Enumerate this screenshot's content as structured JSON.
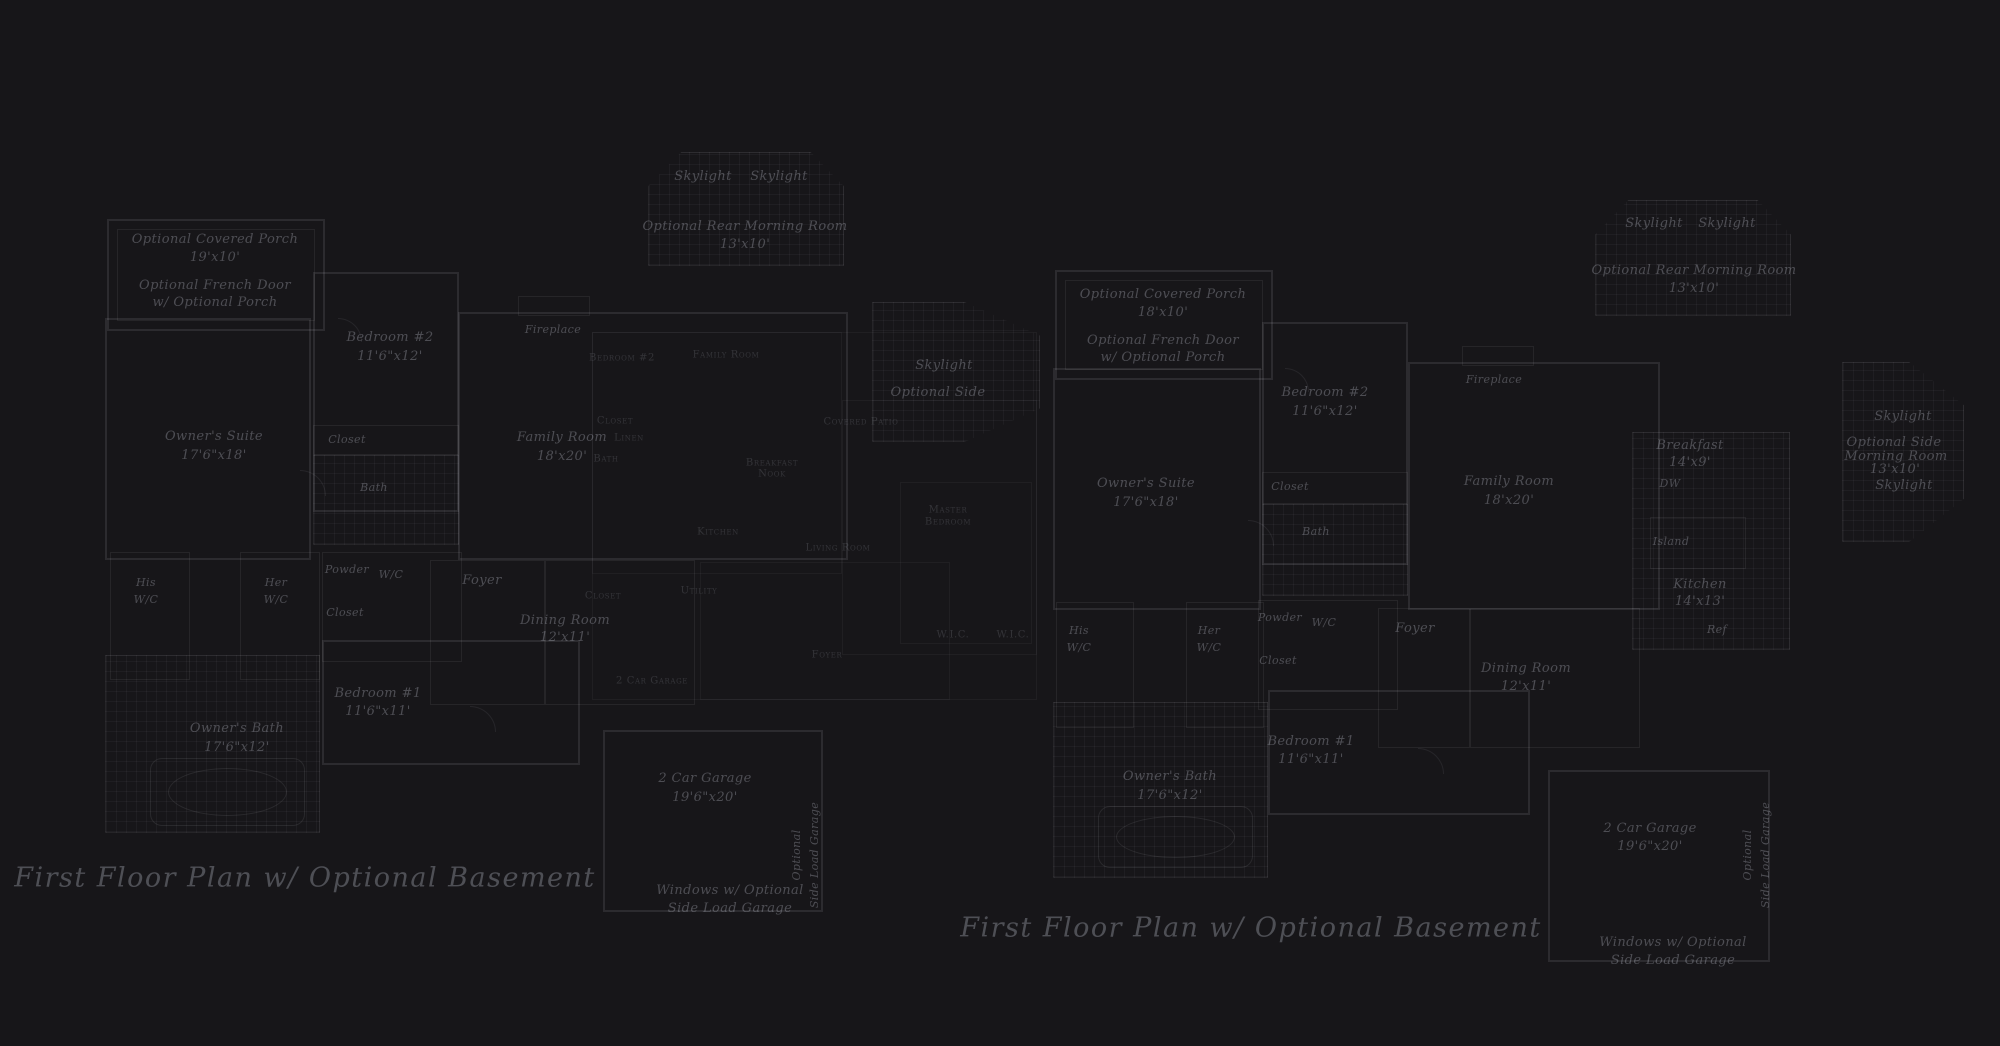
{
  "sheet": {
    "background": "#171619",
    "line_color": "#2b2a2e",
    "text_color": "#4e4e58"
  },
  "captions": {
    "left": {
      "text": "First Floor Plan  w/ Optional Basement"
    },
    "right": {
      "text": "First Floor Plan  w/ Optional Basement"
    }
  },
  "plans": [
    {
      "id": "left-plan",
      "style": "main",
      "labels": [
        {
          "t": "Optional Covered Porch",
          "x": 215,
          "y": 240
        },
        {
          "t": "19'x10'",
          "x": 215,
          "y": 258
        },
        {
          "t": "Optional French Door",
          "x": 215,
          "y": 286
        },
        {
          "t": "w/ Optional Porch",
          "x": 215,
          "y": 303
        },
        {
          "t": "Owner's Suite",
          "x": 214,
          "y": 437
        },
        {
          "t": "17'6\"x18'",
          "x": 214,
          "y": 456
        },
        {
          "t": "Bedroom #2",
          "x": 390,
          "y": 338
        },
        {
          "t": "11'6\"x12'",
          "x": 390,
          "y": 357
        },
        {
          "t": "Closet",
          "x": 347,
          "y": 440,
          "s": "small"
        },
        {
          "t": "Bath",
          "x": 374,
          "y": 488,
          "s": "small"
        },
        {
          "t": "Fireplace",
          "x": 553,
          "y": 330,
          "s": "small"
        },
        {
          "t": "Family Room",
          "x": 562,
          "y": 438
        },
        {
          "t": "18'x20'",
          "x": 562,
          "y": 457
        },
        {
          "t": "Skylight",
          "x": 703,
          "y": 177
        },
        {
          "t": "Skylight",
          "x": 779,
          "y": 177
        },
        {
          "t": "Optional Rear Morning Room",
          "x": 745,
          "y": 227
        },
        {
          "t": "13'x10'",
          "x": 745,
          "y": 245
        },
        {
          "t": "Skylight",
          "x": 944,
          "y": 366
        },
        {
          "t": "Optional Side",
          "x": 938,
          "y": 393
        },
        {
          "t": "His",
          "x": 146,
          "y": 583,
          "s": "small"
        },
        {
          "t": "W/C",
          "x": 146,
          "y": 600,
          "s": "small"
        },
        {
          "t": "Her",
          "x": 276,
          "y": 583,
          "s": "small"
        },
        {
          "t": "W/C",
          "x": 276,
          "y": 600,
          "s": "small"
        },
        {
          "t": "Powder",
          "x": 347,
          "y": 570,
          "s": "small"
        },
        {
          "t": "W/C",
          "x": 391,
          "y": 575,
          "s": "small"
        },
        {
          "t": "Closet",
          "x": 345,
          "y": 613,
          "s": "small"
        },
        {
          "t": "Foyer",
          "x": 482,
          "y": 581
        },
        {
          "t": "Dining Room",
          "x": 565,
          "y": 621
        },
        {
          "t": "12'x11'",
          "x": 565,
          "y": 638
        },
        {
          "t": "Bedroom #1",
          "x": 378,
          "y": 694
        },
        {
          "t": "11'6\"x11'",
          "x": 378,
          "y": 712
        },
        {
          "t": "Owner's Bath",
          "x": 237,
          "y": 729
        },
        {
          "t": "17'6\"x12'",
          "x": 237,
          "y": 748
        },
        {
          "t": "2 Car Garage",
          "x": 705,
          "y": 779
        },
        {
          "t": "19'6\"x20'",
          "x": 705,
          "y": 798
        },
        {
          "t": "Optional",
          "x": 797,
          "y": 855,
          "r": true
        },
        {
          "t": "Side Load Garage",
          "x": 815,
          "y": 855,
          "r": true
        },
        {
          "t": "Windows w/ Optional",
          "x": 730,
          "y": 891
        },
        {
          "t": "Side Load Garage",
          "x": 730,
          "y": 909
        }
      ]
    },
    {
      "id": "right-plan",
      "style": "main",
      "labels": [
        {
          "t": "Optional Covered Porch",
          "x": 1163,
          "y": 295
        },
        {
          "t": "18'x10'",
          "x": 1163,
          "y": 313
        },
        {
          "t": "Optional French Door",
          "x": 1163,
          "y": 341
        },
        {
          "t": "w/ Optional Porch",
          "x": 1163,
          "y": 358
        },
        {
          "t": "Owner's Suite",
          "x": 1146,
          "y": 484
        },
        {
          "t": "17'6\"x18'",
          "x": 1146,
          "y": 503
        },
        {
          "t": "Bedroom #2",
          "x": 1325,
          "y": 393
        },
        {
          "t": "11'6\"x12'",
          "x": 1325,
          "y": 412
        },
        {
          "t": "Closet",
          "x": 1290,
          "y": 487,
          "s": "small"
        },
        {
          "t": "Bath",
          "x": 1316,
          "y": 532,
          "s": "small"
        },
        {
          "t": "Fireplace",
          "x": 1494,
          "y": 380,
          "s": "small"
        },
        {
          "t": "Family Room",
          "x": 1509,
          "y": 482
        },
        {
          "t": "18'x20'",
          "x": 1509,
          "y": 501
        },
        {
          "t": "Skylight",
          "x": 1654,
          "y": 224
        },
        {
          "t": "Skylight",
          "x": 1727,
          "y": 224
        },
        {
          "t": "Optional Rear Morning Room",
          "x": 1694,
          "y": 271
        },
        {
          "t": "13'x10'",
          "x": 1694,
          "y": 289
        },
        {
          "t": "Breakfast",
          "x": 1690,
          "y": 446
        },
        {
          "t": "14'x9'",
          "x": 1690,
          "y": 463
        },
        {
          "t": "DW",
          "x": 1670,
          "y": 484,
          "s": "small"
        },
        {
          "t": "Island",
          "x": 1671,
          "y": 542,
          "s": "small"
        },
        {
          "t": "Kitchen",
          "x": 1700,
          "y": 585
        },
        {
          "t": "14'x13'",
          "x": 1700,
          "y": 602
        },
        {
          "t": "Ref",
          "x": 1717,
          "y": 630,
          "s": "small"
        },
        {
          "t": "Skylight",
          "x": 1903,
          "y": 417
        },
        {
          "t": "Optional Side",
          "x": 1894,
          "y": 443
        },
        {
          "t": "Morning Room",
          "x": 1896,
          "y": 457
        },
        {
          "t": "13'x10'",
          "x": 1895,
          "y": 470
        },
        {
          "t": "Skylight",
          "x": 1904,
          "y": 486
        },
        {
          "t": "His",
          "x": 1079,
          "y": 631,
          "s": "small"
        },
        {
          "t": "W/C",
          "x": 1079,
          "y": 648,
          "s": "small"
        },
        {
          "t": "Her",
          "x": 1209,
          "y": 631,
          "s": "small"
        },
        {
          "t": "W/C",
          "x": 1209,
          "y": 648,
          "s": "small"
        },
        {
          "t": "Powder",
          "x": 1280,
          "y": 618,
          "s": "small"
        },
        {
          "t": "W/C",
          "x": 1324,
          "y": 623,
          "s": "small"
        },
        {
          "t": "Closet",
          "x": 1278,
          "y": 661,
          "s": "small"
        },
        {
          "t": "Foyer",
          "x": 1415,
          "y": 629
        },
        {
          "t": "Dining Room",
          "x": 1526,
          "y": 669
        },
        {
          "t": "12'x11'",
          "x": 1526,
          "y": 687
        },
        {
          "t": "Bedroom #1",
          "x": 1311,
          "y": 742
        },
        {
          "t": "11'6\"x11'",
          "x": 1311,
          "y": 760
        },
        {
          "t": "Owner's Bath",
          "x": 1170,
          "y": 777
        },
        {
          "t": "17'6\"x12'",
          "x": 1170,
          "y": 796
        },
        {
          "t": "2 Car Garage",
          "x": 1650,
          "y": 829
        },
        {
          "t": "19'6\"x20'",
          "x": 1650,
          "y": 847
        },
        {
          "t": "Optional",
          "x": 1748,
          "y": 855,
          "r": true
        },
        {
          "t": "Side Load Garage",
          "x": 1766,
          "y": 855,
          "r": true
        },
        {
          "t": "Windows w/ Optional",
          "x": 1673,
          "y": 943
        },
        {
          "t": "Side Load Garage",
          "x": 1673,
          "y": 961
        }
      ]
    },
    {
      "id": "underlay-plan",
      "style": "under",
      "labels": [
        {
          "t": "Bedroom #2",
          "x": 622,
          "y": 358
        },
        {
          "t": "Family Room",
          "x": 726,
          "y": 355
        },
        {
          "t": "Closet",
          "x": 615,
          "y": 421
        },
        {
          "t": "Linen",
          "x": 629,
          "y": 438
        },
        {
          "t": "Bath",
          "x": 606,
          "y": 459
        },
        {
          "t": "Breakfast",
          "x": 772,
          "y": 463
        },
        {
          "t": "Nook",
          "x": 772,
          "y": 474
        },
        {
          "t": "Covered Patio",
          "x": 861,
          "y": 422
        },
        {
          "t": "Kitchen",
          "x": 718,
          "y": 532
        },
        {
          "t": "Utility",
          "x": 699,
          "y": 591
        },
        {
          "t": "Closet",
          "x": 603,
          "y": 596
        },
        {
          "t": "Living Room",
          "x": 838,
          "y": 548
        },
        {
          "t": "Master",
          "x": 948,
          "y": 510
        },
        {
          "t": "Bedroom",
          "x": 948,
          "y": 522
        },
        {
          "t": "W.I.C.",
          "x": 953,
          "y": 635
        },
        {
          "t": "W.I.C.",
          "x": 1013,
          "y": 635
        },
        {
          "t": "Foyer",
          "x": 827,
          "y": 655
        },
        {
          "t": "2 Car Garage",
          "x": 652,
          "y": 681
        }
      ]
    }
  ]
}
